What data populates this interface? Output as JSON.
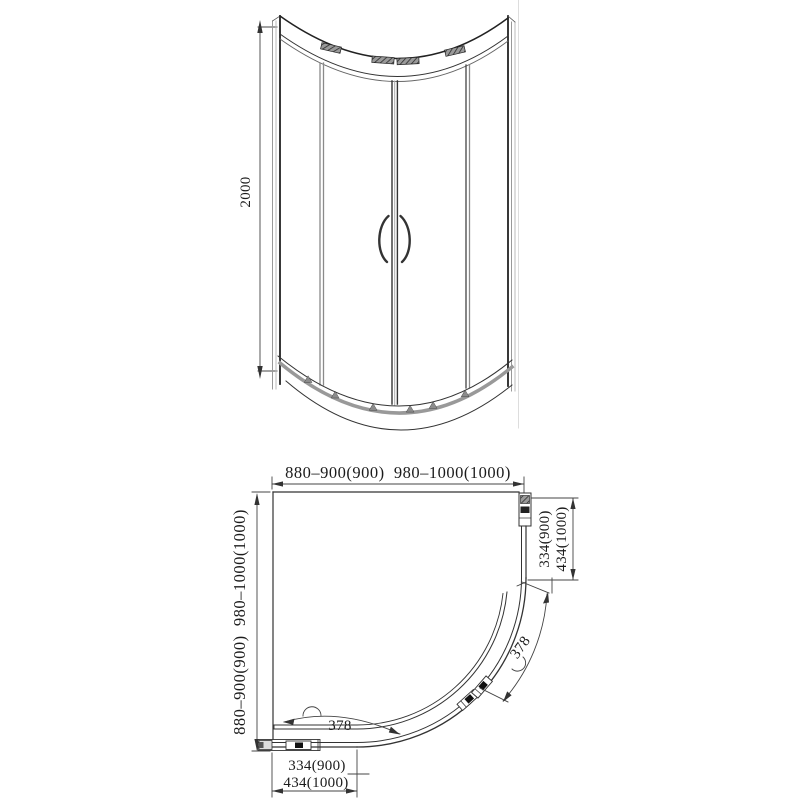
{
  "drawing": {
    "type": "shower-enclosure-technical-drawing",
    "colors": {
      "line": "#333333",
      "light_line": "#888888",
      "track_gray": "#999999",
      "background": "#ffffff"
    }
  },
  "front_view": {
    "height_dim": "2000"
  },
  "plan_view": {
    "top_width_dim": "880–900(900)  980–1000(1000)",
    "left_depth_dim": "880–900(900)  980–1000(1000)",
    "right_opening_dims": [
      "334(900)",
      "434(1000)"
    ],
    "bottom_opening_dims": [
      "334(900)",
      "434(1000)"
    ],
    "door_arc_dims": [
      "378",
      "378"
    ]
  }
}
